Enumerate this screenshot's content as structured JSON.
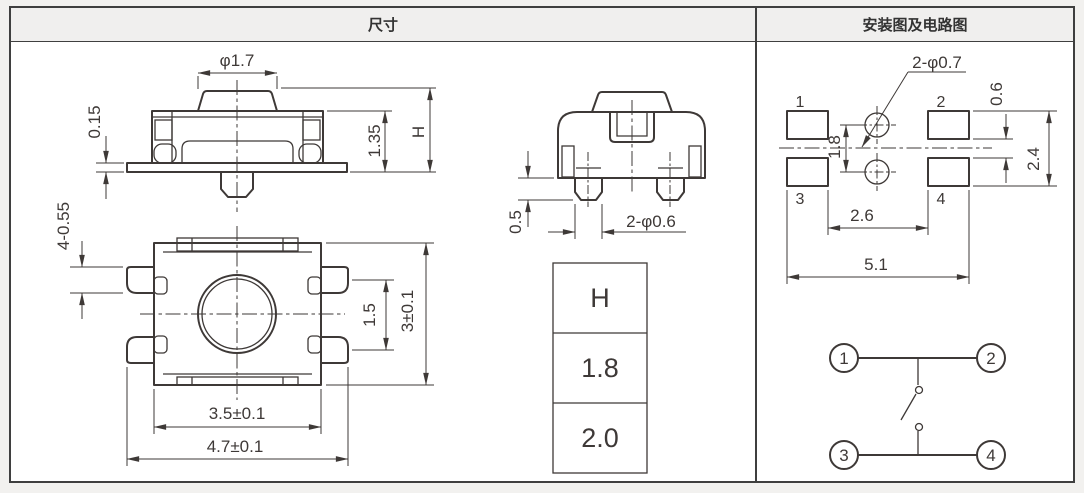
{
  "header": {
    "left_title": "尺寸",
    "right_title": "安装图及电路图"
  },
  "dimensions_panel": {
    "front_view": {
      "dim_button_dia": "φ1.7",
      "dim_foot_thickness": "0.15",
      "dim_base_height": "1.35",
      "dim_total_height": "H"
    },
    "side_view": {
      "dim_leg_protrusion": "0.5",
      "dim_legs": "2-φ0.6"
    },
    "top_view": {
      "dim_leads": "4-0.55",
      "dim_lead_pitch": "1.5",
      "dim_body_depth": "3±0.1",
      "dim_body_width": "3.5±0.1",
      "dim_overall_width": "4.7±0.1"
    },
    "h_table": {
      "rows": [
        "H",
        "1.8",
        "2.0"
      ]
    }
  },
  "mounting_panel": {
    "pcb_layout": {
      "dim_holes": "2-φ0.7",
      "pad_labels": [
        "1",
        "2",
        "3",
        "4"
      ],
      "dim_hole_pitch": "1.8",
      "dim_pad_gap": "0.6",
      "dim_pad_row_span": "2.4",
      "dim_pad_inner_span": "2.6",
      "dim_pad_outer_span": "5.1"
    },
    "circuit": {
      "terminal_labels": [
        "1",
        "2",
        "3",
        "4"
      ]
    }
  },
  "colors": {
    "page_bg": "#f2f1ef",
    "header_bg": "#f0efee",
    "panel_bg": "#ffffff",
    "border": "#3f3f3f",
    "line": "#3e3937",
    "text": "#333333"
  }
}
